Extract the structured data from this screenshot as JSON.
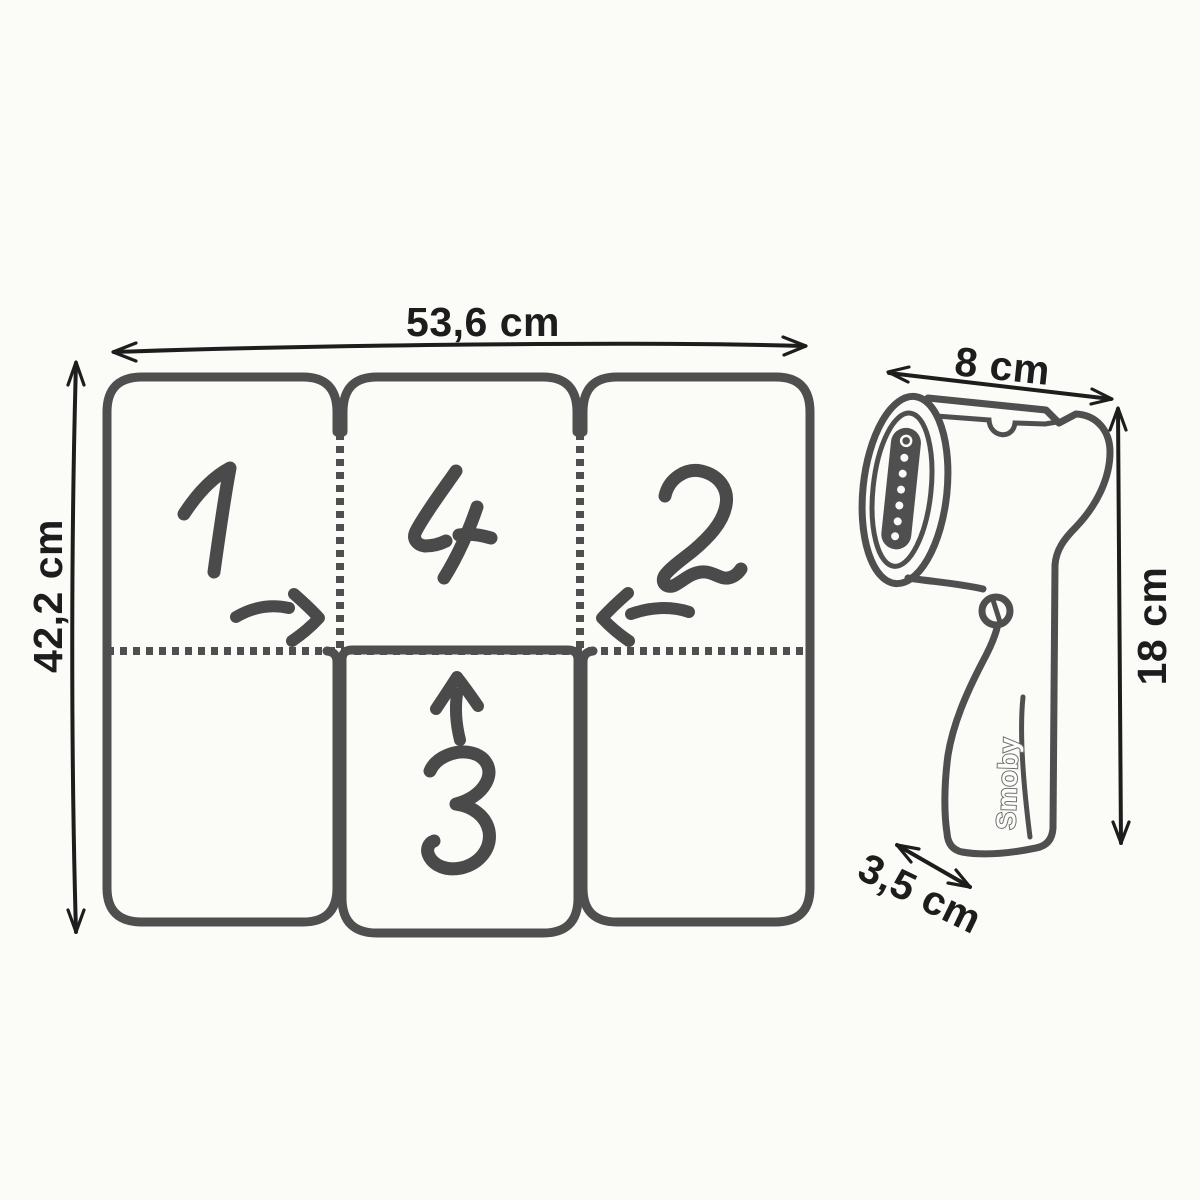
{
  "image": {
    "type": "product-dimensions-illustration",
    "background_color": "#fbfbf8",
    "line_color": "#4f4f4f",
    "dimension_color": "#1d1d1d"
  },
  "mat_diagram": {
    "description": "foldable ironing mat with 6 panels and fold order arrows",
    "width_label": "53,6 cm",
    "height_label": "42,2 cm",
    "panel_numbers": [
      "1",
      "4",
      "2",
      "3"
    ],
    "fold_arrows": [
      "right",
      "left",
      "up"
    ]
  },
  "steamer_diagram": {
    "description": "handheld toy garment steamer side view",
    "brand": "Smoby",
    "width_label": "8 cm",
    "height_label": "18 cm",
    "depth_label": "3,5 cm"
  }
}
